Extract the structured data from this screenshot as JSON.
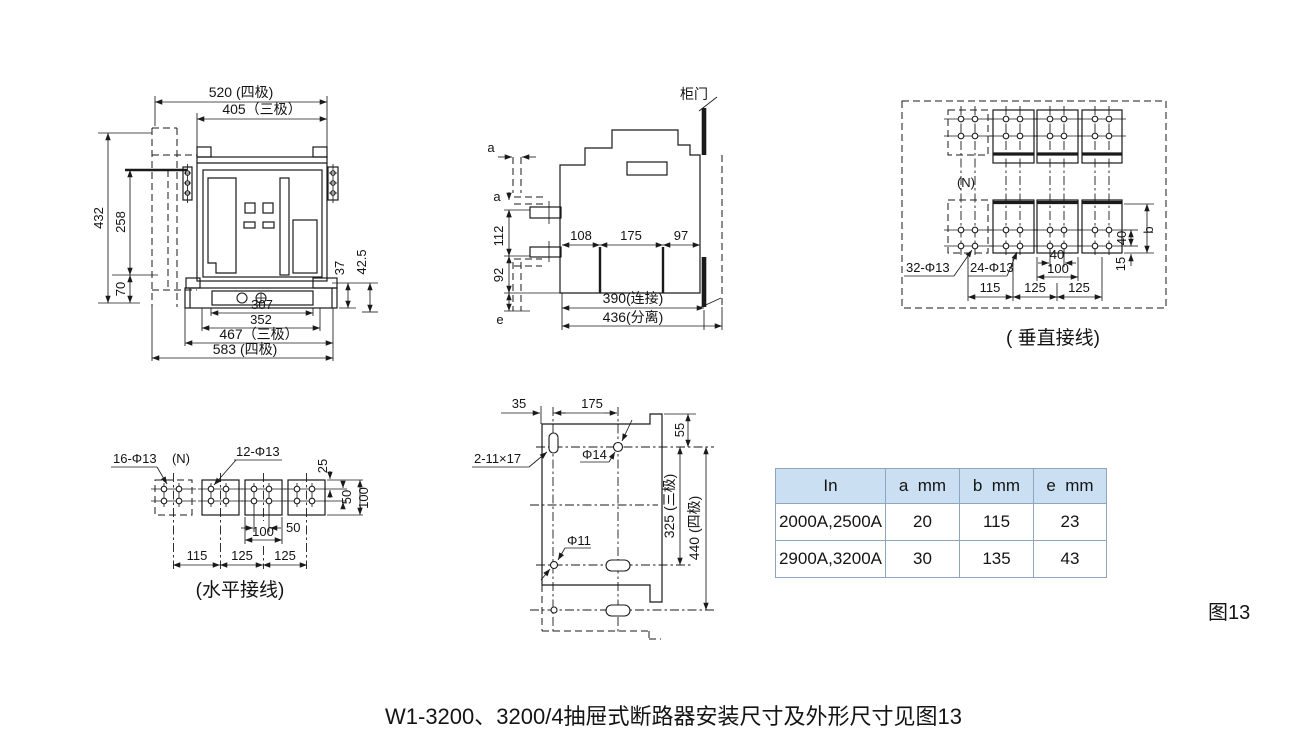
{
  "page": {
    "caption": "W1-3200、3200/4抽屉式断路器安装尺寸及外形尺寸见图13",
    "figure_label": "图13",
    "background": "#ffffff"
  },
  "front_view": {
    "dims": {
      "w4": "520 (四极)",
      "w3": "405（三极）",
      "h_total": "432",
      "h_body": "258",
      "h_base": "70",
      "d37": "37",
      "d42_5": "42.5",
      "d307": "307",
      "d352": "352",
      "d467": "467（三极）",
      "d583": "583 (四极)"
    }
  },
  "side_view": {
    "door_label": "柜门",
    "dims": {
      "a_top": "a",
      "a_left": "a",
      "d112": "112",
      "d92": "92",
      "e": "e",
      "d108": "108",
      "d175": "175",
      "d97": "97",
      "connected": "390(连接)",
      "separated": "436(分离)"
    }
  },
  "vertical_wiring": {
    "caption": "( 垂直接线)",
    "neutral": "(N)",
    "holes_32": "32-Φ13",
    "holes_24": "24-Φ13",
    "dims": {
      "d115": "115",
      "d125a": "125",
      "d125b": "125",
      "d40_h": "40",
      "d100_h": "100",
      "d40_v": "40",
      "d15": "15",
      "b": "b"
    }
  },
  "horizontal_wiring": {
    "caption": "(水平接线)",
    "neutral": "(N)",
    "holes_16": "16-Φ13",
    "holes_12": "12-Φ13",
    "dims": {
      "d25": "25",
      "d50_v": "50",
      "d100_v": "100",
      "d50_h": "50",
      "d100_h": "100",
      "d115": "115",
      "d125a": "125",
      "d125b": "125"
    }
  },
  "mounting_plate": {
    "labels": {
      "slot": "2-11×17",
      "hole14": "Φ14",
      "hole11": "Φ11"
    },
    "dims": {
      "d35": "35",
      "d175": "175",
      "d55": "55",
      "h3": "325 (三极)",
      "h4": "440 (四极)"
    }
  },
  "spec_table": {
    "headers": [
      "In",
      "a  mm",
      "b  mm",
      "e  mm"
    ],
    "rows": [
      {
        "in": "2000A,2500A",
        "a": "20",
        "b": "115",
        "e": "23"
      },
      {
        "in": "2900A,3200A",
        "a": "30",
        "b": "135",
        "e": "43"
      }
    ],
    "header_bg": "#cbdff2",
    "border_color": "#8ea6bb"
  }
}
